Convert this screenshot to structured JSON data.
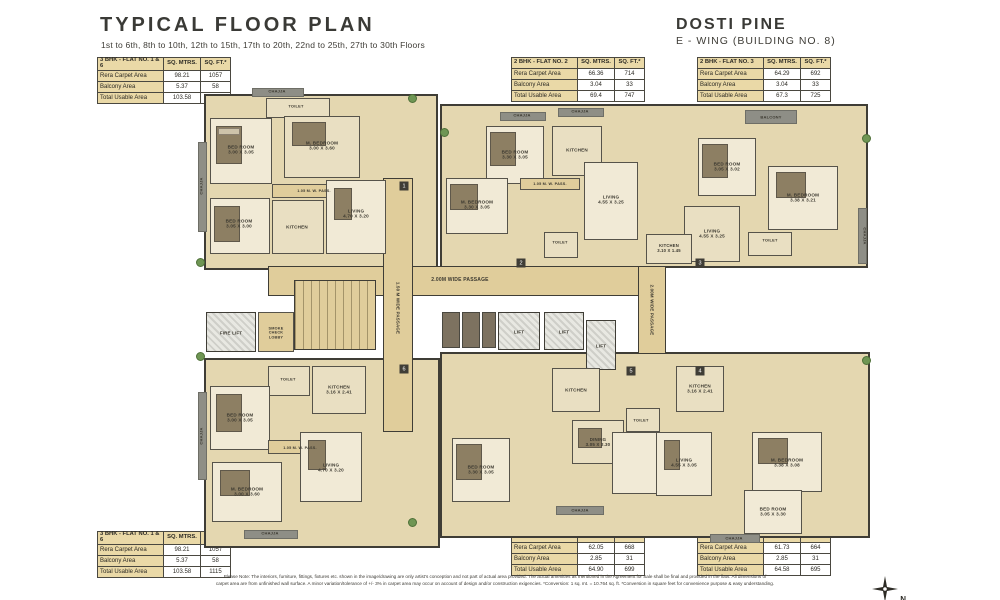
{
  "header": {
    "title": "TYPICAL FLOOR PLAN",
    "subtitle": "1st to 6th, 8th to 10th, 12th to 15th, 17th to 20th, 22nd to 25th, 27th to 30th Floors",
    "project": "DOSTI PINE",
    "wing": "E - WING (BUILDING NO. 8)"
  },
  "colors": {
    "table_header_beige": "#ead9a7",
    "passage_tan": "#e0cd9b",
    "wall_dark": "#3f3d36",
    "chajja_gray": "#8e8e86",
    "plant_green": "#6f9654"
  },
  "tables": [
    {
      "title": "3 BHK - FLAT NO. 1 & 6",
      "col1": "SQ. MTRS.",
      "col2": "SQ. FT.*",
      "rows": [
        [
          "Rera Carpet Area",
          "98.21",
          "1057"
        ],
        [
          "Balcony Area",
          "5.37",
          "58"
        ],
        [
          "Total Usable Area",
          "103.58",
          "1115"
        ]
      ]
    },
    {
      "title": "2 BHK - FLAT NO. 2",
      "col1": "SQ. MTRS.",
      "col2": "SQ. FT.*",
      "rows": [
        [
          "Rera Carpet Area",
          "66.36",
          "714"
        ],
        [
          "Balcony Area",
          "3.04",
          "33"
        ],
        [
          "Total Usable Area",
          "69.4",
          "747"
        ]
      ]
    },
    {
      "title": "2 BHK - FLAT NO. 3",
      "col1": "SQ. MTRS.",
      "col2": "SQ. FT.*",
      "rows": [
        [
          "Rera Carpet Area",
          "64.29",
          "692"
        ],
        [
          "Balcony Area",
          "3.04",
          "33"
        ],
        [
          "Total Usable Area",
          "67.3",
          "725"
        ]
      ]
    },
    {
      "title": "3 BHK - FLAT NO. 1 & 6",
      "col1": "SQ. MTRS.",
      "col2": "SQ. FT.*",
      "rows": [
        [
          "Rera Carpet Area",
          "98.21",
          "1057"
        ],
        [
          "Balcony Area",
          "5.37",
          "58"
        ],
        [
          "Total Usable Area",
          "103.58",
          "1115"
        ]
      ]
    },
    {
      "title": "2 BHK - FLAT NO. 5",
      "col1": "SQ. MTRS.",
      "col2": "SQ. FT.*",
      "rows": [
        [
          "Rera Carpet Area",
          "62.05",
          "668"
        ],
        [
          "Balcony Area",
          "2.85",
          "31"
        ],
        [
          "Total Usable Area",
          "64.90",
          "699"
        ]
      ]
    },
    {
      "title": "2 BHK - FLAT NO. 4",
      "col1": "SQ. MTRS.",
      "col2": "SQ. FT.*",
      "rows": [
        [
          "Rera Carpet Area",
          "61.73",
          "664"
        ],
        [
          "Balcony Area",
          "2.85",
          "31"
        ],
        [
          "Total Usable Area",
          "64.58",
          "695"
        ]
      ]
    }
  ],
  "plan": {
    "labels": [
      {
        "t": "CHAJJA",
        "x": 277,
        "y": 92,
        "s": 4
      },
      {
        "t": "TOILET",
        "x": 296,
        "y": 107,
        "s": 4
      },
      {
        "t": "BED ROOM\n3.00 X 3.05",
        "x": 241,
        "y": 150,
        "s": 4.6
      },
      {
        "t": "M. BEDROOM\n3.00 X 3.60",
        "x": 322,
        "y": 146,
        "s": 4.6
      },
      {
        "t": "1.05 M. W. PASS.",
        "x": 314,
        "y": 191,
        "s": 3.8
      },
      {
        "t": "BED ROOM\n3.05 X 3.00",
        "x": 239,
        "y": 224,
        "s": 4.6
      },
      {
        "t": "KITCHEN",
        "x": 297,
        "y": 227,
        "s": 4.6
      },
      {
        "t": "LIVING\n4.70 X 3.20",
        "x": 356,
        "y": 214,
        "s": 4.6
      },
      {
        "t": "CHAJJA",
        "x": 202,
        "y": 186,
        "s": 4,
        "r": -90
      },
      {
        "t": "TOILET",
        "x": 288,
        "y": 380,
        "s": 4
      },
      {
        "t": "KITCHEN\n3.16 X 2.41",
        "x": 339,
        "y": 390,
        "s": 4.6
      },
      {
        "t": "BED ROOM\n3.00 X 3.05",
        "x": 240,
        "y": 418,
        "s": 4.6
      },
      {
        "t": "1.05 M. W. PASS.",
        "x": 300,
        "y": 448,
        "s": 3.8
      },
      {
        "t": "M. BEDROOM\n3.00 X 3.60",
        "x": 247,
        "y": 492,
        "s": 4.6
      },
      {
        "t": "LIVING\n4.70 X 3.20",
        "x": 331,
        "y": 468,
        "s": 4.6
      },
      {
        "t": "CHAJJA",
        "x": 270,
        "y": 534,
        "s": 4
      },
      {
        "t": "CHAJJA",
        "x": 202,
        "y": 436,
        "s": 4,
        "r": -90
      },
      {
        "t": "2.00M  WIDE  PASSAGE",
        "x": 460,
        "y": 281,
        "s": 5
      },
      {
        "t": "1.50 M  WIDE  PASSAGE",
        "x": 398,
        "y": 308,
        "s": 4.4,
        "r": 90
      },
      {
        "t": "2.00M  WIDE  PASSAGE",
        "x": 652,
        "y": 310,
        "s": 4.4,
        "r": 90
      },
      {
        "t": "FIRE LIFT",
        "x": 231,
        "y": 333,
        "s": 4.4
      },
      {
        "t": "SMOKE\nCHECK\nLOBBY",
        "x": 276,
        "y": 333,
        "s": 3.8
      },
      {
        "t": "LIFT",
        "x": 519,
        "y": 332,
        "s": 4.6
      },
      {
        "t": "LIFT",
        "x": 564,
        "y": 332,
        "s": 4.6
      },
      {
        "t": "LIFT",
        "x": 601,
        "y": 346,
        "s": 4.6
      },
      {
        "t": "CHAJJA",
        "x": 522,
        "y": 116,
        "s": 4
      },
      {
        "t": "CHAJJA",
        "x": 580,
        "y": 112,
        "s": 4
      },
      {
        "t": "BED ROOM\n3.30 X 3.05",
        "x": 515,
        "y": 155,
        "s": 4.6
      },
      {
        "t": "KITCHEN",
        "x": 577,
        "y": 150,
        "s": 4.6
      },
      {
        "t": "M. BEDROOM\n3.30 X 3.05",
        "x": 477,
        "y": 205,
        "s": 4.6
      },
      {
        "t": "1.05 M. W. PASS.",
        "x": 550,
        "y": 184,
        "s": 3.8
      },
      {
        "t": "LIVING\n4.55 X 3.25",
        "x": 611,
        "y": 200,
        "s": 4.6
      },
      {
        "t": "TOILET",
        "x": 560,
        "y": 243,
        "s": 4
      },
      {
        "t": "BALCONY",
        "x": 771,
        "y": 118,
        "s": 4
      },
      {
        "t": "BED ROOM\n3.05 X 3.02",
        "x": 727,
        "y": 167,
        "s": 4.6
      },
      {
        "t": "M. BEDROOM\n3.38 X 3.21",
        "x": 803,
        "y": 198,
        "s": 4.6
      },
      {
        "t": "LIVING\n4.55 X 3.25",
        "x": 712,
        "y": 234,
        "s": 4.6
      },
      {
        "t": "KITCHEN\n3.10 X 1.45",
        "x": 669,
        "y": 249,
        "s": 4.2
      },
      {
        "t": "TOILET",
        "x": 770,
        "y": 241,
        "s": 4
      },
      {
        "t": "CHAJJA",
        "x": 864,
        "y": 236,
        "s": 4,
        "r": 90
      },
      {
        "t": "KITCHEN\n3.16 X 2.41",
        "x": 700,
        "y": 389,
        "s": 4.6
      },
      {
        "t": "KITCHEN",
        "x": 576,
        "y": 390,
        "s": 4.6
      },
      {
        "t": "DINING\n3.05 X 2.30",
        "x": 598,
        "y": 442,
        "s": 4.4
      },
      {
        "t": "BED ROOM\n3.30 X 3.05",
        "x": 481,
        "y": 470,
        "s": 4.6
      },
      {
        "t": "LIVING\n4.55 X 3.05",
        "x": 684,
        "y": 463,
        "s": 4.6
      },
      {
        "t": "M. BEDROOM\n3.38 X 3.08",
        "x": 787,
        "y": 463,
        "s": 4.6
      },
      {
        "t": "BED ROOM\n3.05 X 3.30",
        "x": 773,
        "y": 512,
        "s": 4.6
      },
      {
        "t": "TOILET",
        "x": 641,
        "y": 421,
        "s": 4
      },
      {
        "t": "CHAJJA",
        "x": 580,
        "y": 511,
        "s": 4
      },
      {
        "t": "CHAJJA",
        "x": 734,
        "y": 539,
        "s": 4
      }
    ],
    "badges": [
      {
        "n": "1",
        "x": 404,
        "y": 186
      },
      {
        "n": "2",
        "x": 521,
        "y": 263
      },
      {
        "n": "3",
        "x": 700,
        "y": 263
      },
      {
        "n": "4",
        "x": 700,
        "y": 371
      },
      {
        "n": "5",
        "x": 631,
        "y": 371
      },
      {
        "n": "6",
        "x": 404,
        "y": 369
      }
    ]
  },
  "footer": {
    "line1": "Please Note: The interiors, furniture, fittings, fixtures etc. shown in the image/drawing are only artist's conception and not part of actual area provided. The actual amenities as mentioned in the Agreement for Sale shall be final and provided in the flats. All dimensions of",
    "line2": "carpet area are from unfinished wall surface. A minor variation/tolerance of +/- 3% in carpet area may occur on account of design and/or construction exigencies. *Conversion: 1 sq. mt. = 10.764 sq. ft. *Conversion in square feet for convenience purpose & easy understanding."
  },
  "compass": {
    "label": "N"
  }
}
